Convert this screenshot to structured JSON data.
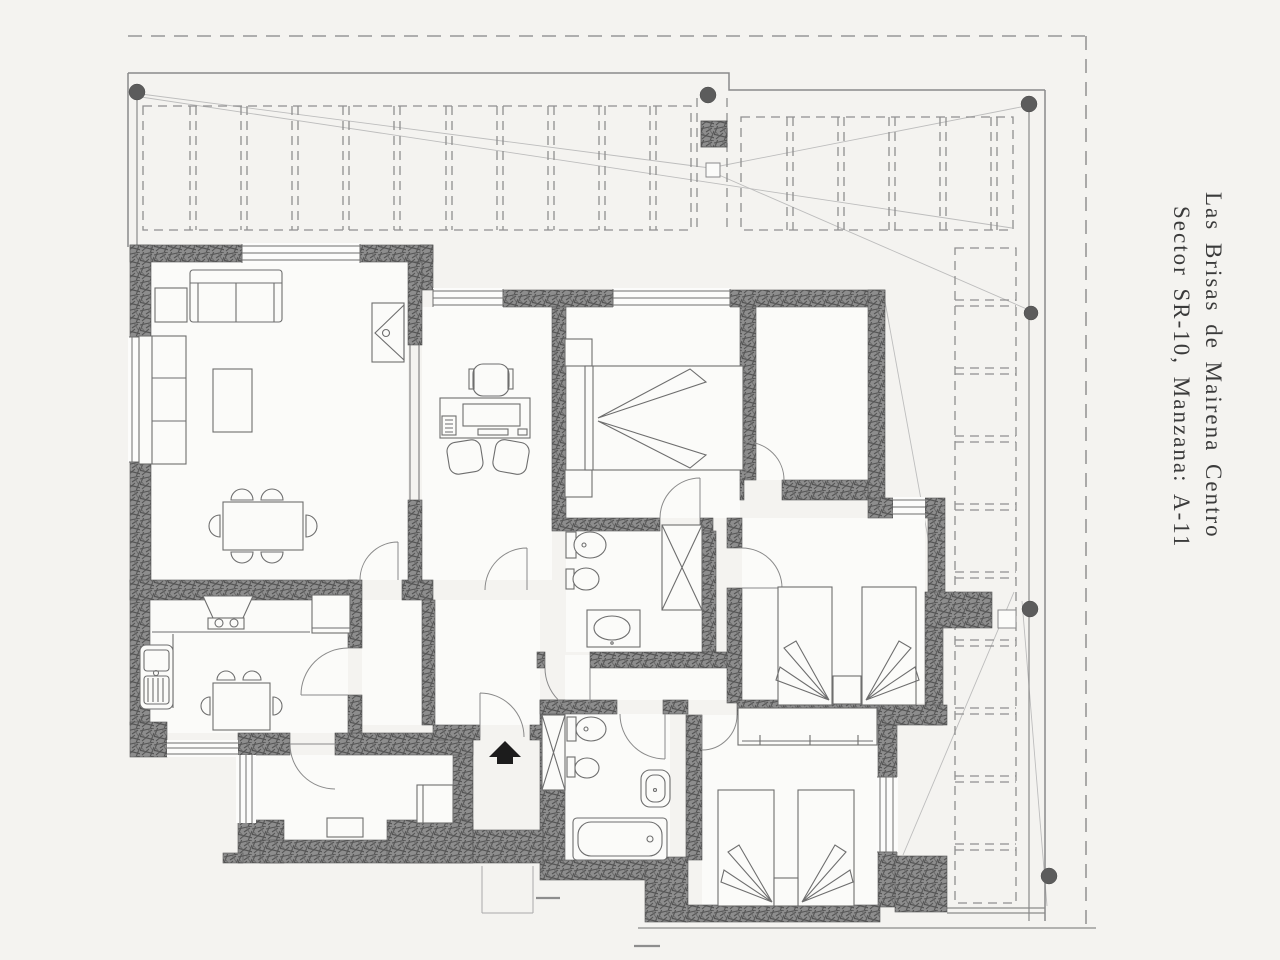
{
  "title": {
    "line1": "Las Brisas de Mairena Centro",
    "line2": "Sector SR-10, Manzana: A-11"
  },
  "colors": {
    "paper": "#f4f3f0",
    "floor": "#fbfbf9",
    "line": "#8a8a8a",
    "wline": "#6e6e6e",
    "dash": "#979797",
    "text": "#3b3b3b",
    "black": "#1c1c1c"
  }
}
